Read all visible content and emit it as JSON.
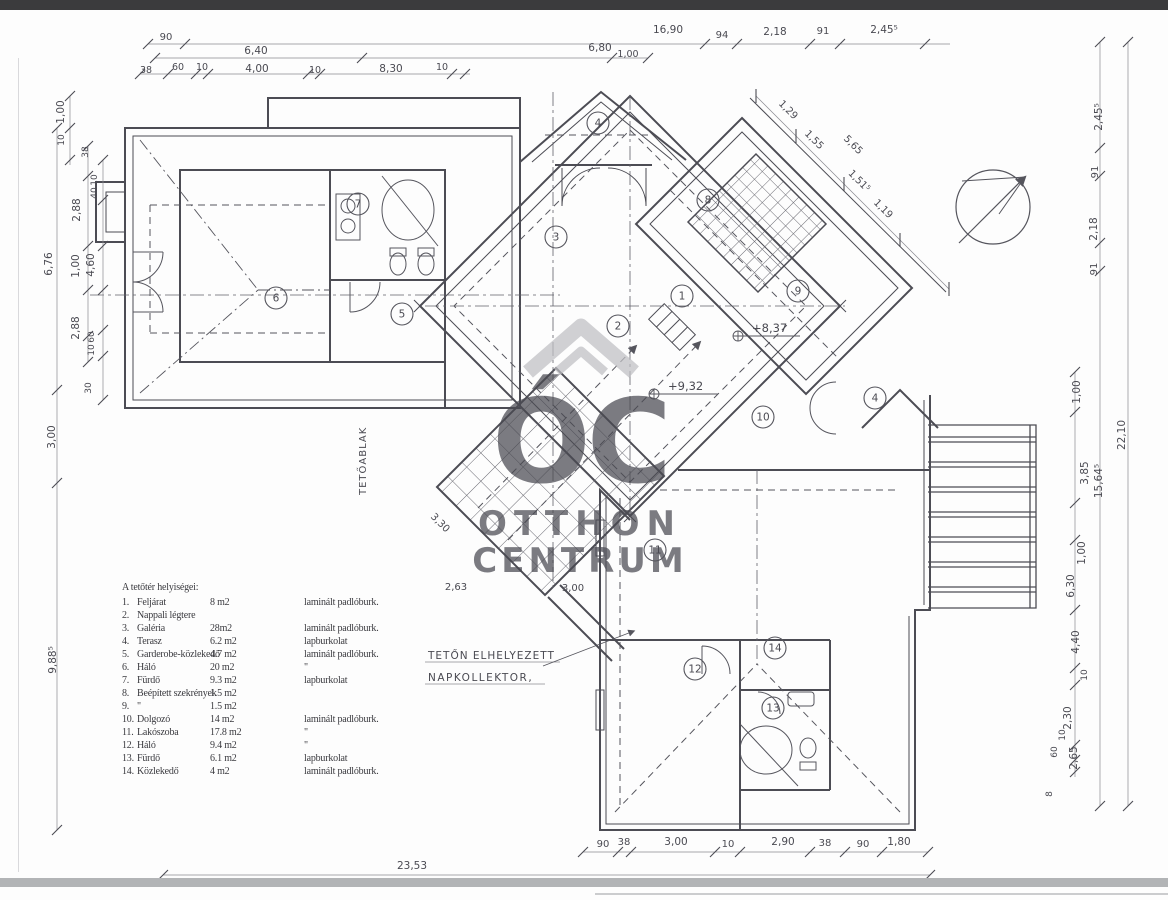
{
  "page": {
    "background": "#fdfdfd",
    "top_bar_color": "#3b3b3d",
    "bottom_bar_color": "#b2b4b6",
    "line_color": "#4c4c54",
    "watermark_color": "#bfbfc3"
  },
  "watermark": {
    "monogram": "ÓC",
    "line1": "OTTHON",
    "line2": "CENTRUM",
    "icon": "house-roof-chevron"
  },
  "legend": {
    "title": "A tetőtér helyiségei:",
    "rows": [
      {
        "num": "1.",
        "name": "Feljárat",
        "area": "8 m2",
        "floor": "laminált padlóburk."
      },
      {
        "num": "2.",
        "name": "Nappali légtere",
        "area": "",
        "floor": ""
      },
      {
        "num": "3.",
        "name": "Galéria",
        "area": "28m2",
        "floor": "laminált padlóburk."
      },
      {
        "num": "4.",
        "name": "Terasz",
        "area": "6.2 m2",
        "floor": "lapburkolat"
      },
      {
        "num": "5.",
        "name": "Garderobe-közlekedő",
        "area": "4.7 m2",
        "floor": "laminált padlóburk."
      },
      {
        "num": "6.",
        "name": "Háló",
        "area": "20 m2",
        "floor": "\""
      },
      {
        "num": "7.",
        "name": "Fürdő",
        "area": "9.3 m2",
        "floor": "lapburkolat"
      },
      {
        "num": "8.",
        "name": "Beépített szekrények",
        "area": "1.5 m2",
        "floor": ""
      },
      {
        "num": "9.",
        "name": "\"",
        "area": "1.5 m2",
        "floor": ""
      },
      {
        "num": "10.",
        "name": "Dolgozó",
        "area": "14 m2",
        "floor": "laminált padlóburk."
      },
      {
        "num": "11.",
        "name": "Lakószoba",
        "area": "17.8 m2",
        "floor": "\""
      },
      {
        "num": "12.",
        "name": "Háló",
        "area": "9.4 m2",
        "floor": "\""
      },
      {
        "num": "13.",
        "name": "Fürdő",
        "area": "6.1 m2",
        "floor": "lapburkolat"
      },
      {
        "num": "14.",
        "name": "Közlekedő",
        "area": "4 m2",
        "floor": "laminált padlóburk."
      }
    ]
  },
  "rooms": [
    {
      "n": "4",
      "x": 598,
      "y": 123
    },
    {
      "n": "7",
      "x": 358,
      "y": 204
    },
    {
      "n": "3",
      "x": 556,
      "y": 237
    },
    {
      "n": "8",
      "x": 708,
      "y": 200
    },
    {
      "n": "6",
      "x": 276,
      "y": 298
    },
    {
      "n": "5",
      "x": 402,
      "y": 314
    },
    {
      "n": "1",
      "x": 682,
      "y": 296
    },
    {
      "n": "9",
      "x": 798,
      "y": 291
    },
    {
      "n": "2",
      "x": 618,
      "y": 326
    },
    {
      "n": "10",
      "x": 763,
      "y": 417
    },
    {
      "n": "4",
      "x": 875,
      "y": 398
    },
    {
      "n": "11",
      "x": 655,
      "y": 550
    },
    {
      "n": "14",
      "x": 775,
      "y": 648
    },
    {
      "n": "12",
      "x": 695,
      "y": 669
    },
    {
      "n": "13",
      "x": 773,
      "y": 708
    }
  ],
  "dims": {
    "labels": [
      {
        "t": "90",
        "x": 166,
        "y": 40,
        "s": 10
      },
      {
        "t": "16,90",
        "x": 668,
        "y": 33
      },
      {
        "t": "6,40",
        "x": 256,
        "y": 54
      },
      {
        "t": "6,80",
        "x": 600,
        "y": 51
      },
      {
        "t": "1,00",
        "x": 628,
        "y": 57,
        "s": 9.5
      },
      {
        "t": "38",
        "x": 146,
        "y": 73,
        "s": 9.5
      },
      {
        "t": "60",
        "x": 178,
        "y": 70,
        "s": 9.5
      },
      {
        "t": "10",
        "x": 202,
        "y": 70,
        "s": 9.5
      },
      {
        "t": "4,00",
        "x": 257,
        "y": 72
      },
      {
        "t": "10",
        "x": 315,
        "y": 73,
        "s": 9.5
      },
      {
        "t": "8,30",
        "x": 391,
        "y": 72
      },
      {
        "t": "10",
        "x": 442,
        "y": 70,
        "s": 9.5
      },
      {
        "t": "94",
        "x": 722,
        "y": 38,
        "s": 10
      },
      {
        "t": "2,18",
        "x": 775,
        "y": 35
      },
      {
        "t": "91",
        "x": 823,
        "y": 34,
        "s": 10
      },
      {
        "t": "2,45⁵",
        "x": 884,
        "y": 33
      },
      {
        "t": "1,29",
        "x": 786,
        "y": 112,
        "r": 45,
        "s": 10
      },
      {
        "t": "1,55",
        "x": 812,
        "y": 142,
        "r": 45,
        "s": 10
      },
      {
        "t": "5,65",
        "x": 851,
        "y": 147,
        "r": 45,
        "s": 10
      },
      {
        "t": "1,51⁵",
        "x": 857,
        "y": 183,
        "r": 45,
        "s": 10
      },
      {
        "t": "1,19",
        "x": 881,
        "y": 211,
        "r": 45,
        "s": 10
      },
      {
        "t": "1,00",
        "x": 64,
        "y": 112,
        "r": -90
      },
      {
        "t": "10",
        "x": 64,
        "y": 140,
        "r": -90,
        "s": 9
      },
      {
        "t": "38",
        "x": 88,
        "y": 152,
        "r": -90,
        "s": 9
      },
      {
        "t": "10",
        "x": 97,
        "y": 180,
        "r": -90,
        "s": 9
      },
      {
        "t": "40",
        "x": 97,
        "y": 193,
        "r": -90,
        "s": 9
      },
      {
        "t": "2,88",
        "x": 80,
        "y": 210,
        "r": -90
      },
      {
        "t": "1,00",
        "x": 79,
        "y": 266,
        "r": -90
      },
      {
        "t": "4,60",
        "x": 94,
        "y": 265,
        "r": -90
      },
      {
        "t": "2,88",
        "x": 79,
        "y": 328,
        "r": -90
      },
      {
        "t": "60",
        "x": 94,
        "y": 337,
        "r": -90,
        "s": 9
      },
      {
        "t": "10",
        "x": 94,
        "y": 350,
        "r": -90,
        "s": 9
      },
      {
        "t": "30",
        "x": 91,
        "y": 388,
        "r": -90,
        "s": 9
      },
      {
        "t": "6,76",
        "x": 52,
        "y": 264,
        "r": -90
      },
      {
        "t": "3,00",
        "x": 55,
        "y": 437,
        "r": -90
      },
      {
        "t": "9,88⁵",
        "x": 56,
        "y": 660,
        "r": -90
      },
      {
        "t": "2,45⁵",
        "x": 1102,
        "y": 117,
        "r": -90
      },
      {
        "t": "91",
        "x": 1098,
        "y": 172,
        "r": -90,
        "s": 10
      },
      {
        "t": "2,18",
        "x": 1097,
        "y": 229,
        "r": -90
      },
      {
        "t": "91",
        "x": 1097,
        "y": 269,
        "r": -90,
        "s": 10
      },
      {
        "t": "1,00",
        "x": 1080,
        "y": 392,
        "r": -90
      },
      {
        "t": "22,10",
        "x": 1125,
        "y": 435,
        "r": -90
      },
      {
        "t": "3,85",
        "x": 1088,
        "y": 473,
        "r": -90
      },
      {
        "t": "15,64⁵",
        "x": 1102,
        "y": 481,
        "r": -90
      },
      {
        "t": "1,00",
        "x": 1085,
        "y": 553,
        "r": -90
      },
      {
        "t": "6,30",
        "x": 1074,
        "y": 586,
        "r": -90
      },
      {
        "t": "4,40",
        "x": 1079,
        "y": 642,
        "r": -90
      },
      {
        "t": "10",
        "x": 1087,
        "y": 675,
        "r": -90,
        "s": 9
      },
      {
        "t": "2,30",
        "x": 1071,
        "y": 718,
        "r": -90
      },
      {
        "t": "10",
        "x": 1065,
        "y": 735,
        "r": -90,
        "s": 9
      },
      {
        "t": "60",
        "x": 1057,
        "y": 752,
        "r": -90,
        "s": 9
      },
      {
        "t": "2,65",
        "x": 1077,
        "y": 758,
        "r": -90
      },
      {
        "t": "8",
        "x": 1052,
        "y": 794,
        "r": -90,
        "s": 9
      },
      {
        "t": "90",
        "x": 603,
        "y": 847,
        "s": 10
      },
      {
        "t": "38",
        "x": 624,
        "y": 845,
        "s": 10
      },
      {
        "t": "3,00",
        "x": 676,
        "y": 845
      },
      {
        "t": "10",
        "x": 728,
        "y": 847,
        "s": 10
      },
      {
        "t": "2,90",
        "x": 783,
        "y": 845
      },
      {
        "t": "38",
        "x": 825,
        "y": 846,
        "s": 10
      },
      {
        "t": "90",
        "x": 863,
        "y": 847,
        "s": 10
      },
      {
        "t": "1,80",
        "x": 899,
        "y": 845
      },
      {
        "t": "23,53",
        "x": 412,
        "y": 869
      },
      {
        "t": "3,30",
        "x": 438,
        "y": 525,
        "r": 45,
        "s": 10
      },
      {
        "t": "2,63",
        "x": 456,
        "y": 590,
        "s": 10
      },
      {
        "t": "3,00",
        "x": 573,
        "y": 591,
        "s": 10
      }
    ]
  },
  "elevations": [
    {
      "text": "+8,37",
      "x": 752,
      "y": 332
    },
    {
      "text": "+9,32",
      "x": 668,
      "y": 390
    }
  ],
  "annotations": [
    {
      "text": "TETŐABLAK",
      "x": 366,
      "y": 495,
      "r": -90,
      "s": 10,
      "ls": 1
    },
    {
      "text": "TETŐN ELHELYEZETT",
      "x": 428,
      "y": 659,
      "s": 10.5,
      "ls": 1
    },
    {
      "text": "NAPKOLLEKTOR,",
      "x": 428,
      "y": 681,
      "s": 10.5,
      "ls": 1.5
    }
  ],
  "north_indicator": "north-arrow"
}
